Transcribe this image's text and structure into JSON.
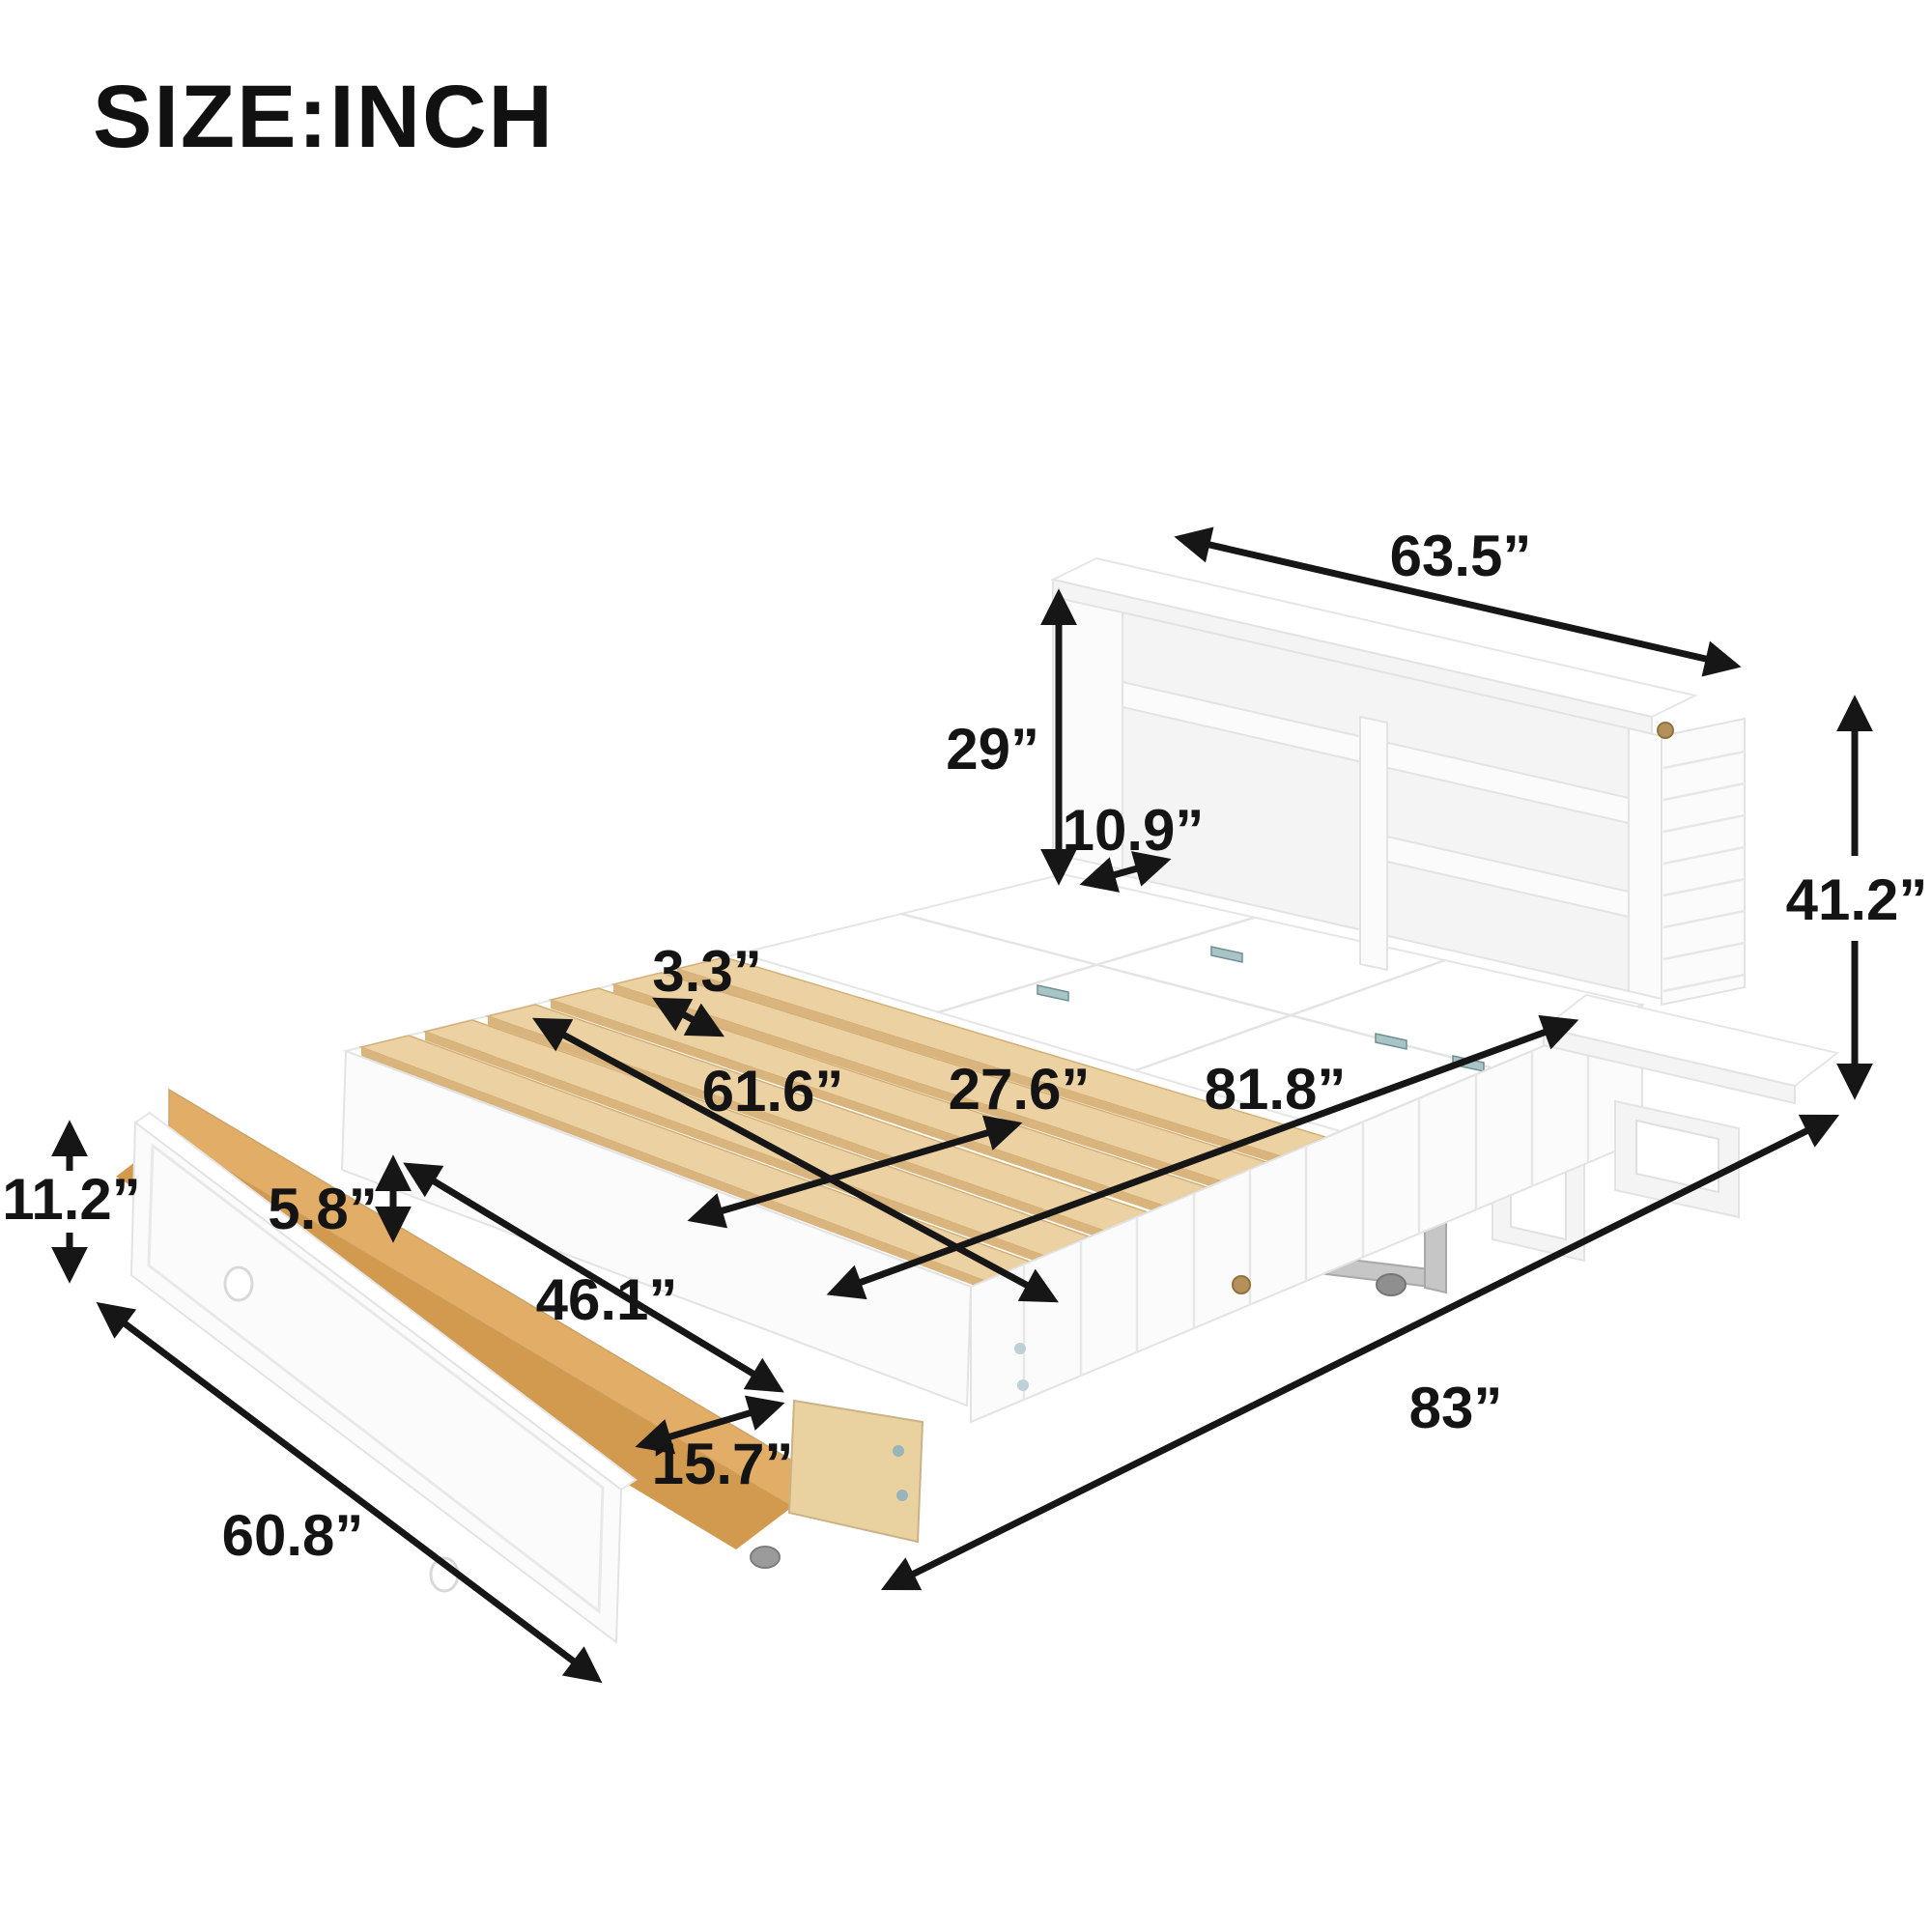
{
  "title": "SIZE:INCH",
  "unit": "inch",
  "accent_colors": {
    "arrow_and_text": "#141414",
    "furniture_white": "#fbfbfb",
    "slat_wood": "#ecd2a3",
    "drawer_wood": "#d19a4e",
    "hinge_metal": "#a9c4c6",
    "latch_brass": "#b5905a"
  },
  "dimensions": {
    "cabinet_width": {
      "value": 63.5,
      "label": "63.5”"
    },
    "headboard_height": {
      "value": 29,
      "label": "29”"
    },
    "shelf_depth": {
      "value": 10.9,
      "label": "10.9”"
    },
    "cabinet_height": {
      "value": 41.2,
      "label": "41.2”"
    },
    "slat_spacing": {
      "value": 3.3,
      "label": "3.3”"
    },
    "slat_section_length": {
      "value": 61.6,
      "label": "61.6”"
    },
    "slat_length": {
      "value": 27.6,
      "label": "27.6”"
    },
    "bed_length": {
      "value": 81.8,
      "label": "81.8”"
    },
    "overall_length": {
      "value": 83,
      "label": "83”"
    },
    "drawer_height": {
      "value": 11.2,
      "label": "11.2”"
    },
    "drawer_inner_depth": {
      "value": 5.8,
      "label": "5.8”"
    },
    "drawer_inner_length": {
      "value": 46.1,
      "label": "46.1”"
    },
    "drawer_inner_width": {
      "value": 15.7,
      "label": "15.7”"
    },
    "drawer_length": {
      "value": 60.8,
      "label": "60.8”"
    }
  }
}
